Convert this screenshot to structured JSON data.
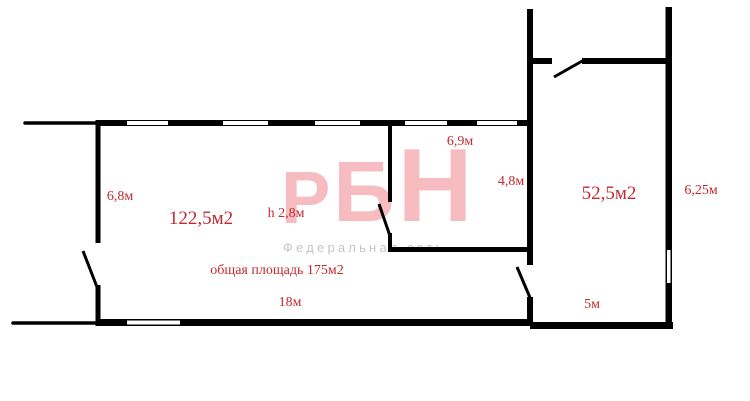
{
  "theme": {
    "background": "#ffffff",
    "wall_color": "#000000",
    "label_color": "#c22a30",
    "watermark_pink": "#f6bcc0",
    "watermark_gray": "#c6c6c6"
  },
  "watermark": {
    "letters": [
      "Р",
      "Б",
      "Н"
    ],
    "subtitle": "Федеральная сеть"
  },
  "labels": {
    "room_main_width": "6,8м",
    "room_main_area": "122,5м2",
    "ceiling_height": "h 2,8м",
    "room_mid_width": "6,9м",
    "room_mid_depth": "4,8м",
    "room_right_area": "52,5м2",
    "room_right_height": "6,25м",
    "total_area": "общая площадь 175м2",
    "room_main_length": "18м",
    "room_right_width": "5м"
  }
}
